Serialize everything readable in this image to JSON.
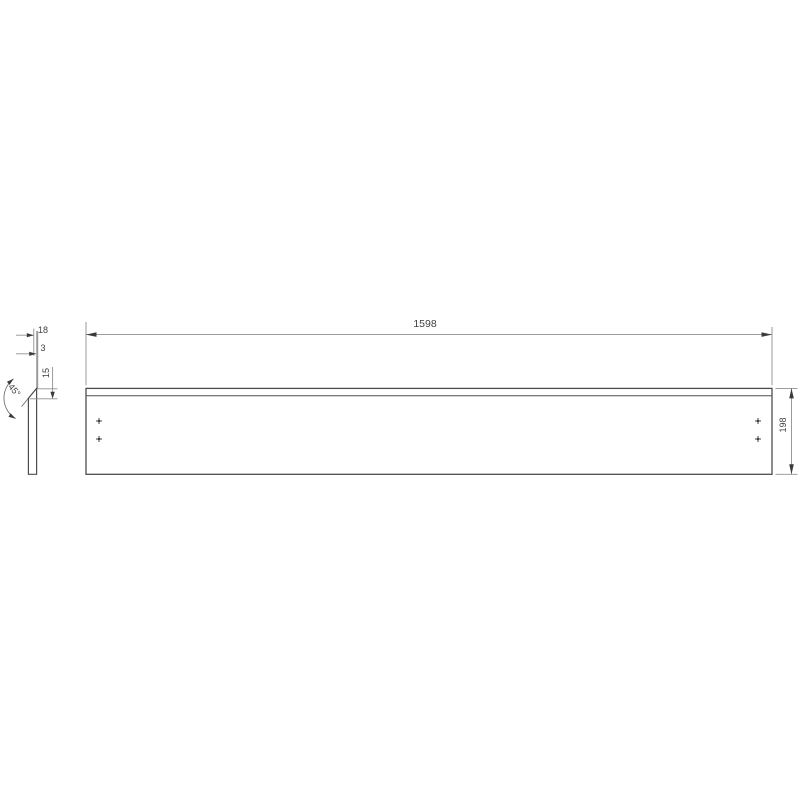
{
  "drawing": {
    "type": "technical-drawing",
    "part": "long rectangular panel with 45-degree chamfered top edge",
    "background_color": "#ffffff",
    "outline_color": "#4d4d4d",
    "dim_line_color": "#8f8f8f",
    "arrow_color": "#3a3a3a",
    "text_color": "#3f3f3f",
    "front_view": {
      "length_label": "1598",
      "height_label": "198",
      "drill_marks": 4
    },
    "side_view": {
      "thickness_label": "18",
      "top_edge_label": "3",
      "chamfer_height_label": "15",
      "chamfer_angle_label": "45°"
    }
  }
}
